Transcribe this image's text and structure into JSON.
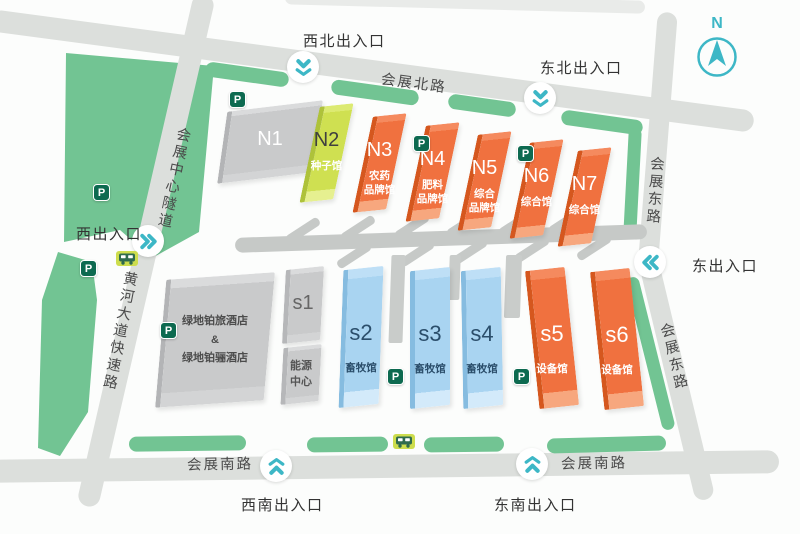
{
  "map": {
    "compass_label": "N",
    "parking_label": "P",
    "entrances": {
      "northwest": "西北出入口",
      "northeast": "东北出入口",
      "west": "西出入口",
      "east": "东出入口",
      "southwest": "西南出入口",
      "southeast": "东南出入口"
    },
    "roads": {
      "north": "会展北路",
      "south_left": "会展南路",
      "south_right": "会展南路",
      "tunnel": "会展中心隧道",
      "west_expressway": "黄河大道快速路",
      "east_upper": "会展东路",
      "east_lower": "会展东路"
    },
    "north_halls": [
      {
        "id": "N1"
      },
      {
        "id": "N2",
        "sub1": "种子馆"
      },
      {
        "id": "N3",
        "sub1": "农药",
        "sub2": "品牌馆"
      },
      {
        "id": "N4",
        "sub1": "肥料",
        "sub2": "品牌馆"
      },
      {
        "id": "N5",
        "sub1": "综合",
        "sub2": "品牌馆"
      },
      {
        "id": "N6",
        "sub1": "综合馆"
      },
      {
        "id": "N7",
        "sub1": "综合馆"
      }
    ],
    "south_halls": [
      {
        "id": "s1"
      },
      {
        "id": "s2",
        "sub1": "畜牧馆"
      },
      {
        "id": "s3",
        "sub1": "畜牧馆"
      },
      {
        "id": "s4",
        "sub1": "畜牧馆"
      },
      {
        "id": "s5",
        "sub1": "设备馆"
      },
      {
        "id": "s6",
        "sub1": "设备馆"
      }
    ],
    "buildings": {
      "hotel_line1": "绿地铂旅酒店",
      "hotel_line2": "&",
      "hotel_line3": "绿地铂骊酒店",
      "energy_line1": "能源",
      "energy_line2": "中心"
    },
    "colors": {
      "teal": "#3db7c6",
      "park_green": "#72c493",
      "hall_orange": "#f0713f",
      "hall_lime": "#cfe051",
      "hall_blue": "#a9d4f1",
      "road_gray": "#dcdfdc",
      "parking_green": "#0d6a50"
    }
  }
}
